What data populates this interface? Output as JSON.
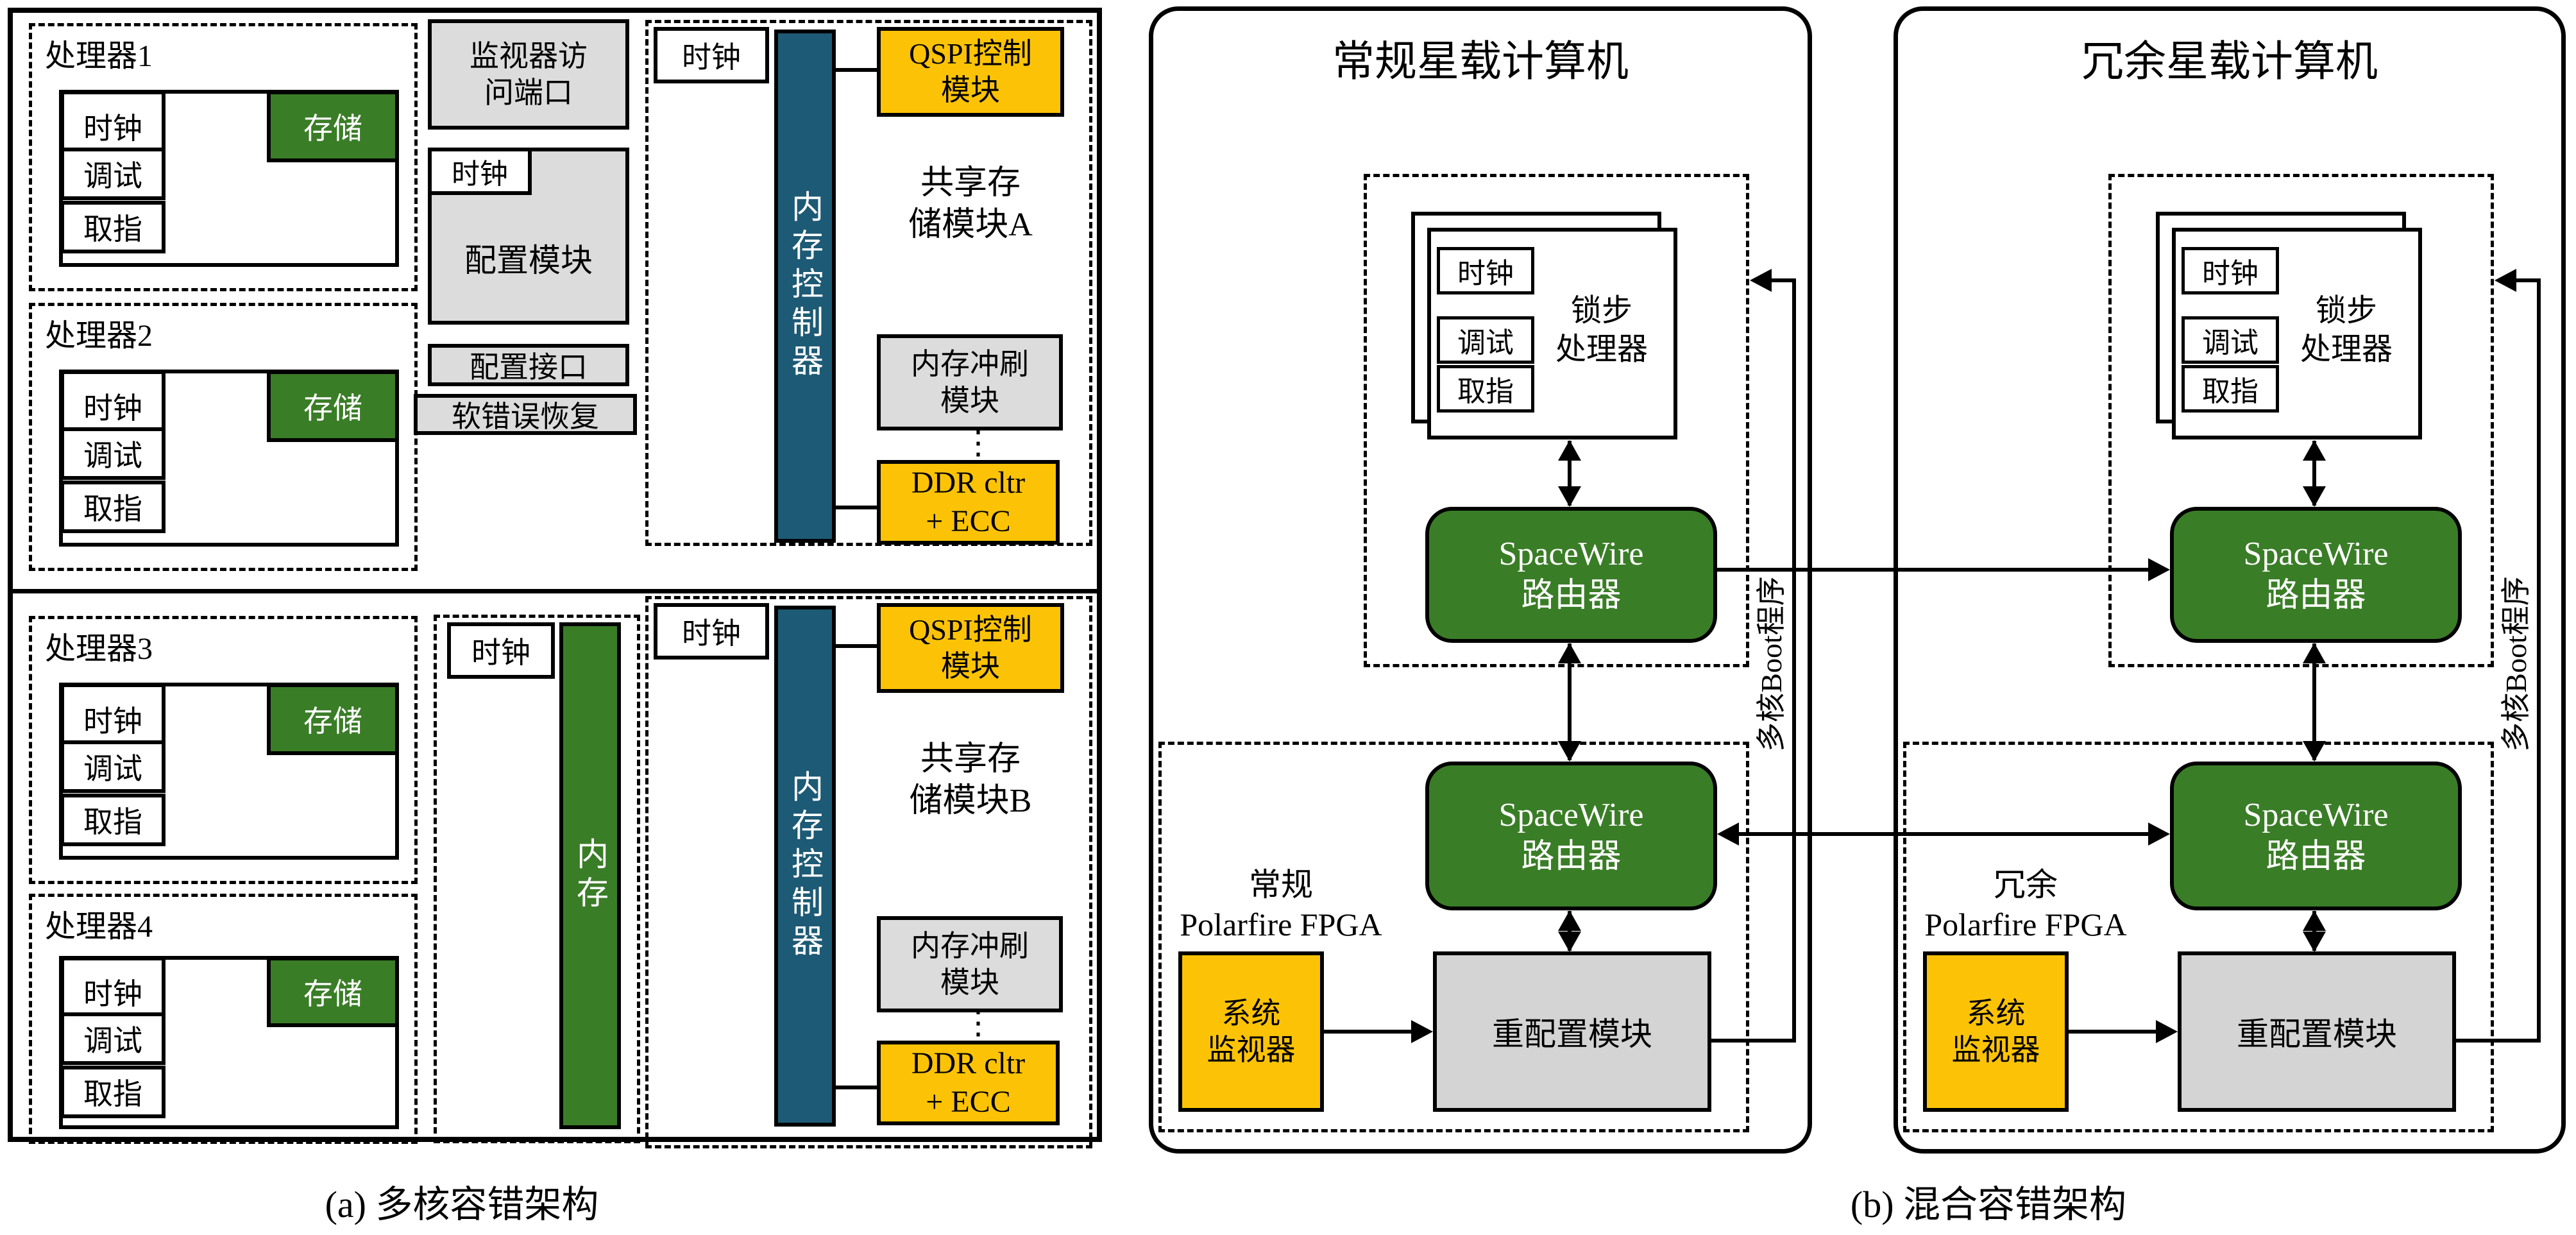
{
  "colors": {
    "accent_green": "#3a7d27",
    "accent_yellow": "#fcc306",
    "accent_teal": "#1d5a75",
    "box_gray": "#dcdcdc"
  },
  "panel_a": {
    "caption": "(a) 多核容错架构",
    "processors": [
      {
        "title": "处理器1",
        "clock": "时钟",
        "debug": "调试",
        "fetch": "取指",
        "mem": "存储"
      },
      {
        "title": "处理器2",
        "clock": "时钟",
        "debug": "调试",
        "fetch": "取指",
        "mem": "存储"
      },
      {
        "title": "处理器3",
        "clock": "时钟",
        "debug": "调试",
        "fetch": "取指",
        "mem": "存储"
      },
      {
        "title": "处理器4",
        "clock": "时钟",
        "debug": "调试",
        "fetch": "取指",
        "mem": "存储"
      }
    ],
    "monitor_port": "监视器访\n问端口",
    "config_clock": "时钟",
    "config_module": "配置模块",
    "config_interface": "配置接口",
    "soft_error": "软错误恢复",
    "mem_clock": "时钟",
    "mem_bar": "内存",
    "modules": [
      {
        "clock": "时钟",
        "controller": "内存控制器",
        "qspi": "QSPI控制\n模块",
        "shared": "共享存\n储模块A",
        "flush": "内存冲刷\n模块",
        "dots": "⋮",
        "ddr": "DDR cltr\n+ ECC"
      },
      {
        "clock": "时钟",
        "controller": "内存控制器",
        "qspi": "QSPI控制\n模块",
        "shared": "共享存\n储模块B",
        "flush": "内存冲刷\n模块",
        "dots": "⋮",
        "ddr": "DDR cltr\n+ ECC"
      }
    ]
  },
  "panel_b": {
    "caption": "(b) 混合容错架构",
    "computers": [
      {
        "title": "常规星载计算机",
        "arch": "常规多核架构",
        "clock": "时钟",
        "debug": "调试",
        "fetch": "取指",
        "lockstep": "锁步\n处理器",
        "router_top": "SpaceWire\n路由器",
        "router_bottom": "SpaceWire\n路由器",
        "fpga": "常规\nPolarfire FPGA",
        "monitor": "系统\n监视器",
        "reconfig": "重配置模块",
        "boot": "多核Boot程序"
      },
      {
        "title": "冗余星载计算机",
        "arch": "冗余多核架构",
        "clock": "时钟",
        "debug": "调试",
        "fetch": "取指",
        "lockstep": "锁步\n处理器",
        "router_top": "SpaceWire\n路由器",
        "router_bottom": "SpaceWire\n路由器",
        "fpga": "冗余\nPolarfire FPGA",
        "monitor": "系统\n监视器",
        "reconfig": "重配置模块",
        "boot": "多核Boot程序"
      }
    ]
  }
}
